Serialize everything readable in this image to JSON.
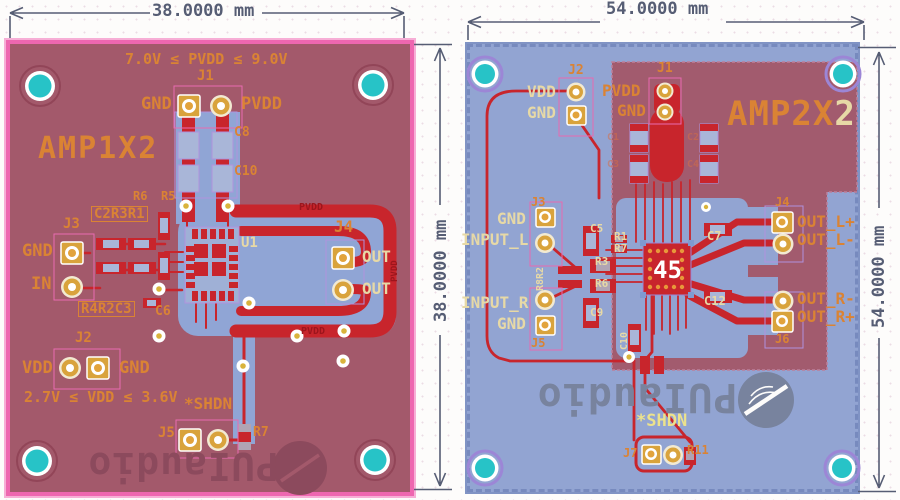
{
  "page": {
    "width": 900,
    "height": 500,
    "description": "PCB layout renders of two audio amplifier boards with dimension annotations"
  },
  "colors": {
    "board_left_fill": "#a3596b",
    "board_left_border": "#ee67b0",
    "board_right_fill": "#92a4d2",
    "pour_rose": "#a25b6e",
    "pour_blue": "#90a5d5",
    "copper_red": "#c8252c",
    "silk_orange": "#da8334",
    "silk_cream": "#e7d9a6",
    "silk_yellow": "#ece28c",
    "net_dark_red": "#9c151c",
    "hole_teal": "#27c3c7",
    "pad_gold": "#d9a33c",
    "outline_purple": "#b092dd",
    "dimension": "#565d74",
    "logo_left": "#8c4a5d",
    "logo_right": "#78839e"
  },
  "dimensions": {
    "left_top": "38.0000 mm",
    "left_side": "38.0000 mm",
    "right_top": "54.0000 mm",
    "right_side": "54.0000 mm"
  },
  "left_board": {
    "name": "AMP1X2",
    "logo_text": "PUIaudio",
    "labels": [
      {
        "n": "pvdd-range",
        "t": "7.0V ≤ PVDD ≤ 9.0V",
        "x": 125,
        "y": 52,
        "c": "org",
        "s": 15
      },
      {
        "n": "j1-ref",
        "t": "J1",
        "x": 197,
        "y": 69,
        "c": "org",
        "s": 14
      },
      {
        "n": "j1-gnd",
        "t": "GND",
        "x": 141,
        "y": 96,
        "c": "org",
        "s": 17
      },
      {
        "n": "j1-pvdd",
        "t": "PVDD",
        "x": 241,
        "y": 96,
        "c": "org",
        "s": 17
      },
      {
        "n": "c8-ref",
        "t": "C8",
        "x": 234,
        "y": 126,
        "c": "org",
        "s": 13
      },
      {
        "n": "c10-ref",
        "t": "C10",
        "x": 234,
        "y": 165,
        "c": "org",
        "s": 13
      },
      {
        "n": "r6-ref",
        "t": "R6",
        "x": 133,
        "y": 190,
        "c": "org",
        "s": 12
      },
      {
        "n": "r5-ref",
        "t": "R5",
        "x": 161,
        "y": 190,
        "c": "org",
        "s": 12
      },
      {
        "n": "c2r3r1-refs",
        "t": "C2R3R1",
        "x": 91,
        "y": 206,
        "c": "org boxed",
        "s": 14
      },
      {
        "n": "j3-ref",
        "t": "J3",
        "x": 63,
        "y": 217,
        "c": "org",
        "s": 14
      },
      {
        "n": "j3-gnd",
        "t": "GND",
        "x": 22,
        "y": 243,
        "c": "org",
        "s": 17
      },
      {
        "n": "j3-in",
        "t": "IN",
        "x": 31,
        "y": 276,
        "c": "org",
        "s": 17
      },
      {
        "n": "r4r2c3-refs",
        "t": "R4R2C3",
        "x": 78,
        "y": 301,
        "c": "org boxed",
        "s": 14
      },
      {
        "n": "c6-ref",
        "t": "C6",
        "x": 155,
        "y": 305,
        "c": "org",
        "s": 13
      },
      {
        "n": "u1-ref",
        "t": "U1",
        "x": 241,
        "y": 236,
        "c": "crm",
        "s": 14
      },
      {
        "n": "pvdd-net-top",
        "t": "PVDD",
        "x": 299,
        "y": 203,
        "c": "red",
        "s": 10
      },
      {
        "n": "j4-ref",
        "t": "J4",
        "x": 334,
        "y": 219,
        "c": "org",
        "s": 16
      },
      {
        "n": "out-top",
        "t": "OUT",
        "x": 362,
        "y": 249,
        "c": "crm",
        "s": 16
      },
      {
        "n": "out-bottom",
        "t": "OUT",
        "x": 362,
        "y": 281,
        "c": "crm",
        "s": 16
      },
      {
        "n": "pvdd-net-right",
        "t": "PVDD",
        "x": 391,
        "y": 282,
        "c": "red",
        "s": 9,
        "r": -90
      },
      {
        "n": "pvdd-net-bottom",
        "t": "PVDD",
        "x": 301,
        "y": 327,
        "c": "red",
        "s": 10
      },
      {
        "n": "j2-ref",
        "t": "J2",
        "x": 75,
        "y": 331,
        "c": "org",
        "s": 14
      },
      {
        "n": "j2-vdd",
        "t": "VDD",
        "x": 22,
        "y": 360,
        "c": "org",
        "s": 17
      },
      {
        "n": "j2-gnd",
        "t": "GND",
        "x": 119,
        "y": 360,
        "c": "org",
        "s": 17
      },
      {
        "n": "vdd-range",
        "t": "2.7V ≤ VDD ≤ 3.6V",
        "x": 24,
        "y": 390,
        "c": "org",
        "s": 15
      },
      {
        "n": "shdn-label",
        "t": "*SHDN",
        "x": 184,
        "y": 396,
        "c": "org",
        "s": 16
      },
      {
        "n": "j5-ref",
        "t": "J5",
        "x": 158,
        "y": 426,
        "c": "org",
        "s": 14
      },
      {
        "n": "r7-ref",
        "t": "R7",
        "x": 253,
        "y": 426,
        "c": "org",
        "s": 13
      }
    ]
  },
  "right_board": {
    "name_main": "AMP2X",
    "name_suffix": "2",
    "logo_text": "PUIaudio",
    "labels": [
      {
        "n": "j2-ref",
        "t": "J2",
        "x": 568,
        "y": 64,
        "c": "org",
        "s": 13
      },
      {
        "n": "j2-vdd",
        "t": "VDD",
        "x": 527,
        "y": 84,
        "c": "crm",
        "s": 16
      },
      {
        "n": "j2-gnd",
        "t": "GND",
        "x": 527,
        "y": 105,
        "c": "crm",
        "s": 16
      },
      {
        "n": "j1-ref",
        "t": "J1",
        "x": 657,
        "y": 62,
        "c": "org",
        "s": 13
      },
      {
        "n": "j1-pvdd",
        "t": "PVDD",
        "x": 602,
        "y": 83,
        "c": "org",
        "s": 16
      },
      {
        "n": "j1-gnd",
        "t": "GND",
        "x": 617,
        "y": 103,
        "c": "org",
        "s": 16
      },
      {
        "n": "c1-ref",
        "t": "C1",
        "x": 607,
        "y": 133,
        "c": "fnt",
        "s": 10
      },
      {
        "n": "c2-ref",
        "t": "C2",
        "x": 687,
        "y": 133,
        "c": "fnt",
        "s": 10
      },
      {
        "n": "c3-ref",
        "t": "C3",
        "x": 607,
        "y": 160,
        "c": "fnt",
        "s": 10
      },
      {
        "n": "c4-ref",
        "t": "C4",
        "x": 687,
        "y": 160,
        "c": "fnt",
        "s": 10
      },
      {
        "n": "j3-ref",
        "t": "J3",
        "x": 531,
        "y": 196,
        "c": "org",
        "s": 12
      },
      {
        "n": "j3-gnd",
        "t": "GND",
        "x": 497,
        "y": 211,
        "c": "crm",
        "s": 16
      },
      {
        "n": "input-l",
        "t": "INPUT_L",
        "x": 461,
        "y": 232,
        "c": "crm",
        "s": 16
      },
      {
        "n": "r8r2-refs",
        "t": "R8R2",
        "x": 536,
        "y": 291,
        "c": "crm",
        "s": 10,
        "r": -90
      },
      {
        "n": "c5-ref",
        "t": "C5",
        "x": 590,
        "y": 223,
        "c": "crm",
        "s": 11
      },
      {
        "n": "r1-ref",
        "t": "R1",
        "x": 614,
        "y": 231,
        "c": "crm",
        "s": 11
      },
      {
        "n": "r7-ref",
        "t": "R7",
        "x": 614,
        "y": 243,
        "c": "crm",
        "s": 11
      },
      {
        "n": "r3-ref",
        "t": "R3",
        "x": 595,
        "y": 256,
        "c": "crm",
        "s": 11
      },
      {
        "n": "r6-ref",
        "t": "R6",
        "x": 595,
        "y": 278,
        "c": "crm",
        "s": 11
      },
      {
        "n": "c9-ref",
        "t": "C9",
        "x": 590,
        "y": 307,
        "c": "crm",
        "s": 11
      },
      {
        "n": "c7-ref",
        "t": "C7",
        "x": 707,
        "y": 230,
        "c": "crm",
        "s": 12
      },
      {
        "n": "c12-ref",
        "t": "C12",
        "x": 704,
        "y": 295,
        "c": "crm",
        "s": 12
      },
      {
        "n": "c10-ref",
        "t": "C10",
        "x": 620,
        "y": 350,
        "c": "crm",
        "s": 10,
        "r": -90
      },
      {
        "n": "chip-marking",
        "t": "45",
        "x": 653,
        "y": 258,
        "c": "wht",
        "s": 24
      },
      {
        "n": "input-r",
        "t": "INPUT_R",
        "x": 461,
        "y": 295,
        "c": "crm",
        "s": 16
      },
      {
        "n": "j5-gnd",
        "t": "GND",
        "x": 497,
        "y": 316,
        "c": "crm",
        "s": 16
      },
      {
        "n": "j5-ref",
        "t": "J5",
        "x": 531,
        "y": 337,
        "c": "org",
        "s": 12
      },
      {
        "n": "j4-ref",
        "t": "J4",
        "x": 775,
        "y": 196,
        "c": "org",
        "s": 12
      },
      {
        "n": "out-l-plus",
        "t": "OUT_L+",
        "x": 797,
        "y": 214,
        "c": "org",
        "s": 16
      },
      {
        "n": "out-l-minus",
        "t": "OUT_L-",
        "x": 797,
        "y": 232,
        "c": "org",
        "s": 16
      },
      {
        "n": "out-r-minus",
        "t": "OUT_R-",
        "x": 797,
        "y": 291,
        "c": "org",
        "s": 16
      },
      {
        "n": "out-r-plus",
        "t": "OUT_R+",
        "x": 797,
        "y": 309,
        "c": "org",
        "s": 16
      },
      {
        "n": "j6-ref",
        "t": "J6",
        "x": 775,
        "y": 333,
        "c": "org",
        "s": 12
      },
      {
        "n": "shdn-label",
        "t": "*SHDN",
        "x": 636,
        "y": 413,
        "c": "yel",
        "s": 17
      },
      {
        "n": "j7-ref",
        "t": "J7",
        "x": 623,
        "y": 447,
        "c": "org",
        "s": 12
      },
      {
        "n": "r11-ref",
        "t": "R11",
        "x": 687,
        "y": 444,
        "c": "org",
        "s": 12
      }
    ]
  }
}
